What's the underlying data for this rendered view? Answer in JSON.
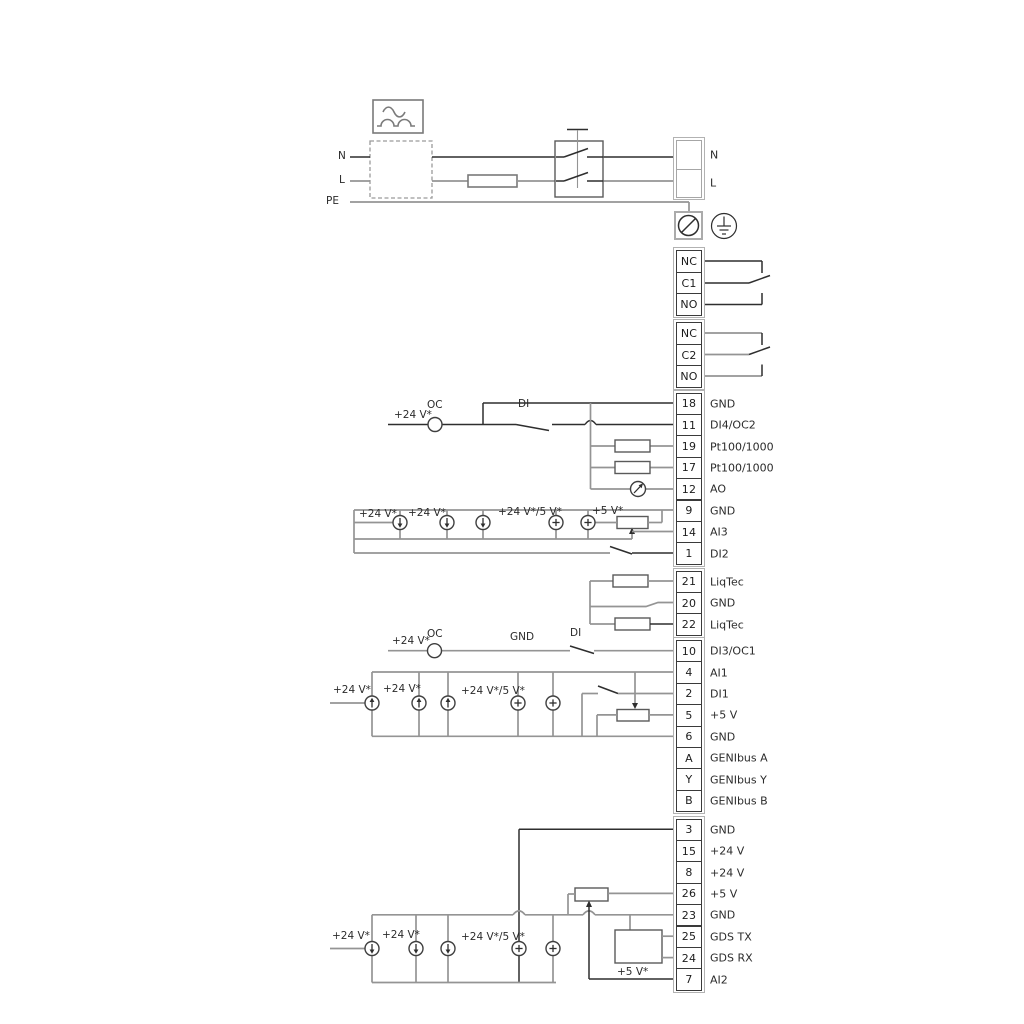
{
  "colors": {
    "wire_dark": "#2e2e2e",
    "wire_gray": "#949494",
    "symbol_outline": "#7a7a7a",
    "text": "#2b2b2b"
  },
  "power_section": {
    "left_labels": [
      "N",
      "L",
      "PE"
    ],
    "right_terminal": {
      "rows": [
        {
          "num": "",
          "label": "N"
        },
        {
          "num": "",
          "label": "L"
        }
      ]
    }
  },
  "relay_blocks": [
    {
      "id": "relay1",
      "cells": [
        "NC",
        "C1",
        "NO"
      ]
    },
    {
      "id": "relay2",
      "cells": [
        "NC",
        "C2",
        "NO"
      ]
    }
  ],
  "terminal_blocks": [
    {
      "id": "blockA",
      "rows": [
        {
          "num": "18",
          "label": "GND"
        },
        {
          "num": "11",
          "label": "DI4/OC2"
        },
        {
          "num": "19",
          "label": "Pt100/1000"
        },
        {
          "num": "17",
          "label": "Pt100/1000"
        },
        {
          "num": "12",
          "label": "AO"
        },
        {
          "num": "9",
          "label": "GND"
        },
        {
          "num": "14",
          "label": "AI3"
        },
        {
          "num": "1",
          "label": "DI2"
        }
      ]
    },
    {
      "id": "blockB",
      "rows": [
        {
          "num": "21",
          "label": "LiqTec"
        },
        {
          "num": "20",
          "label": "GND"
        },
        {
          "num": "22",
          "label": "LiqTec"
        }
      ]
    },
    {
      "id": "blockC",
      "rows": [
        {
          "num": "10",
          "label": "DI3/OC1"
        },
        {
          "num": "4",
          "label": "AI1"
        },
        {
          "num": "2",
          "label": "DI1"
        },
        {
          "num": "5",
          "label": "+5 V"
        },
        {
          "num": "6",
          "label": "GND"
        },
        {
          "num": "A",
          "label": "GENIbus A"
        },
        {
          "num": "Y",
          "label": "GENIbus Y"
        },
        {
          "num": "B",
          "label": "GENIbus B"
        }
      ]
    },
    {
      "id": "blockD",
      "rows": [
        {
          "num": "3",
          "label": "GND"
        },
        {
          "num": "15",
          "label": "+24 V"
        },
        {
          "num": "8",
          "label": "+24 V"
        },
        {
          "num": "26",
          "label": "+5 V"
        },
        {
          "num": "23",
          "label": "GND"
        },
        {
          "num": "25",
          "label": "GDS TX"
        },
        {
          "num": "24",
          "label": "GDS RX"
        },
        {
          "num": "7",
          "label": "AI2"
        }
      ]
    }
  ],
  "wire_labels": [
    {
      "id": "mains-n",
      "text": "N",
      "x": 338,
      "y": 150
    },
    {
      "id": "mains-l",
      "text": "L",
      "x": 339,
      "y": 174
    },
    {
      "id": "mains-pe",
      "text": "PE",
      "x": 326,
      "y": 195
    },
    {
      "id": "oc2-24v",
      "text": "+24 V*",
      "x": 394,
      "y": 409
    },
    {
      "id": "oc2-oc",
      "text": "OC",
      "x": 427,
      "y": 399
    },
    {
      "id": "oc2-di",
      "text": "DI",
      "x": 518,
      "y": 398
    },
    {
      "id": "ai3-24v-1",
      "text": "+24 V*",
      "x": 359,
      "y": 508
    },
    {
      "id": "ai3-24v-2",
      "text": "+24 V*",
      "x": 408,
      "y": 507
    },
    {
      "id": "ai3-24v5v",
      "text": "+24 V*/5 V*",
      "x": 498,
      "y": 506
    },
    {
      "id": "ai3-5v",
      "text": "+5 V*",
      "x": 592,
      "y": 505
    },
    {
      "id": "oc1-24v",
      "text": "+24 V*",
      "x": 392,
      "y": 635
    },
    {
      "id": "oc1-oc",
      "text": "OC",
      "x": 427,
      "y": 628
    },
    {
      "id": "oc1-gnd",
      "text": "GND",
      "x": 510,
      "y": 631
    },
    {
      "id": "oc1-di",
      "text": "DI",
      "x": 570,
      "y": 627
    },
    {
      "id": "ai1-24v-1",
      "text": "+24 V*",
      "x": 333,
      "y": 684
    },
    {
      "id": "ai1-24v-2",
      "text": "+24 V*",
      "x": 383,
      "y": 683
    },
    {
      "id": "ai1-24v5v",
      "text": "+24 V*/5 V*",
      "x": 461,
      "y": 685
    },
    {
      "id": "ai2-24v-1",
      "text": "+24 V*",
      "x": 332,
      "y": 930
    },
    {
      "id": "ai2-24v-2",
      "text": "+24 V*",
      "x": 382,
      "y": 929
    },
    {
      "id": "ai2-24v5v",
      "text": "+24 V*/5 V*",
      "x": 461,
      "y": 931
    },
    {
      "id": "gds-5v",
      "text": "+5 V*",
      "x": 617,
      "y": 966
    }
  ]
}
